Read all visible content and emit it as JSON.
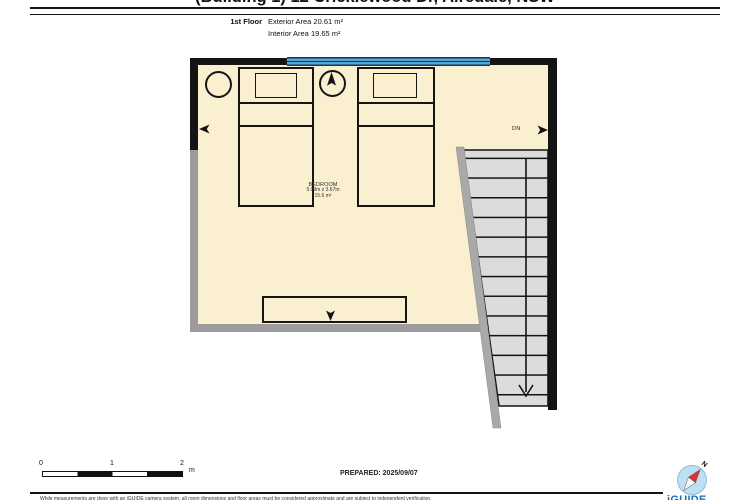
{
  "page": {
    "title": "(Building 1) 12 Cricklewood Dr, Airedale, NSW",
    "prepared": "PREPARED: 2025/09/07",
    "brand": "iGUIDE",
    "disclaimer": "While measurements are done with an iGUIDE camera system, all room dimensions and floor areas must be considered approximate and are subject to independent verification."
  },
  "floor_header": {
    "floor_label": "1st Floor",
    "exterior_area": "Exterior Area 20.61 m²",
    "interior_area": "Interior Area 19.65 m²"
  },
  "floor_plan": {
    "room": {
      "name": "BEDROOM",
      "dimensions": "5.09m x 3.67m",
      "area": "15.6 m²"
    },
    "stairs_label": "DN"
  },
  "scale_bar": {
    "ticks": [
      "0",
      "1",
      "2"
    ],
    "unit": "m"
  },
  "compass": {
    "north_label": "N"
  },
  "colors": {
    "room_fill": "#FAEFCE",
    "wall_black": "#141414",
    "wall_gray": "#9C9C9C",
    "window_blue": "#57A7D8",
    "window_line": "#0E3A5C",
    "stair_fill": "#DCDCDC",
    "stair_wall": "#A9A9A9",
    "brand_blue": "#1F6CB5",
    "compass_red": "#E03131",
    "compass_blue": "#BEE0F4"
  }
}
